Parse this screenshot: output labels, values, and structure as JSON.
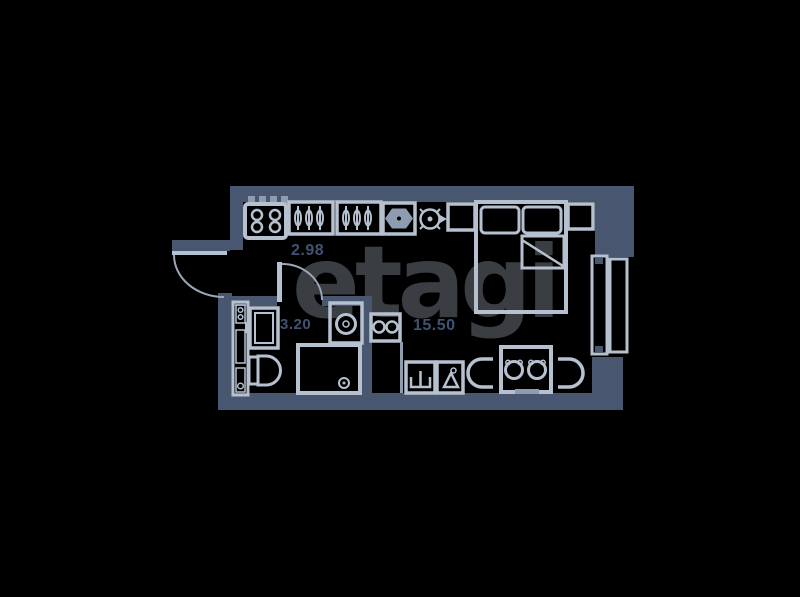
{
  "watermark": {
    "text": "etagi",
    "color": "#3a3d42"
  },
  "palette": {
    "background": "#000000",
    "wall": "#48566f",
    "furniture_line": "#b6c1cf",
    "furniture_soft": "#8e9cb0",
    "label": "#415370"
  },
  "rooms": {
    "hallway": {
      "area": "2.98"
    },
    "bathroom": {
      "area": "3.20"
    },
    "living": {
      "area": "15.50"
    }
  },
  "furniture": [
    "stove-4-burner",
    "wardrobe-hangers",
    "wardrobe-hangers",
    "cabinet-hexagon",
    "ventilation-fan",
    "nightstand",
    "double-bed",
    "nightstand",
    "window",
    "utility-shaft",
    "bathroom-sink",
    "toilet",
    "washing-machine",
    "shower",
    "kitchen-hob-2-burner",
    "kitchen-cabinet-sink",
    "kitchen-cabinet-kettle",
    "dining-table",
    "chair",
    "chair",
    "stool",
    "entry-door",
    "bathroom-door"
  ]
}
